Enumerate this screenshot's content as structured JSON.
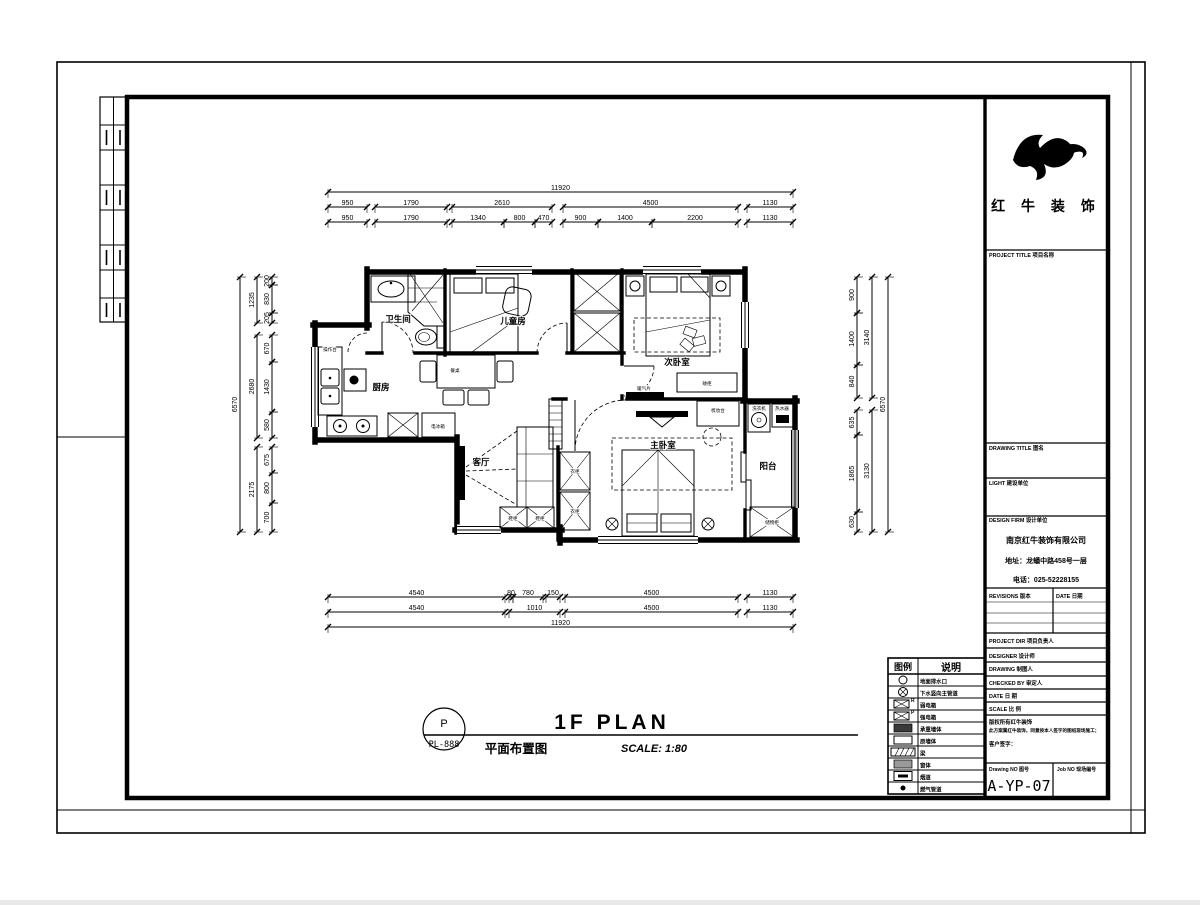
{
  "logo": {
    "company": "红 牛 装 饰"
  },
  "title_block": {
    "project_title": "PROJECT TITLE    项目名称",
    "drawing_title": "DRAWING TITLE    图名",
    "client": "LIGHT    建设单位",
    "design_firm": "DESIGN FIRM    设计单位",
    "firm_name": "南京红牛装饰有限公司",
    "firm_address": "地址：龙蟠中路458号一层",
    "firm_phone": "电话：025-52228155",
    "revisions_label": "REVISIONS  版本",
    "revisions_date_label": "DATE  日期",
    "project_dir": "PROJECT DIR    项目负责人",
    "designer": "DESIGNER    设计师",
    "drawing_by": "DRAWING    制图人",
    "checked_by": "CHECKED BY    审定人",
    "date_label": "DATE    日  期",
    "scale_label": "SCALE    比  例",
    "copyright_line1": "版权所有红牛装饰",
    "copyright_line2": "此方案属红牛装饰，同意按本人签字的图纸现场施工；",
    "copyright_line3": "客户签字：",
    "drawing_no_label": "Drawing NO  图号",
    "drawing_no": "A-YP-07",
    "job_no_label": "Job NO  现场编号"
  },
  "legend": {
    "headers": [
      "图例",
      "说明"
    ],
    "rows": [
      {
        "sym": "circle",
        "label": "地面排水口"
      },
      {
        "sym": "circle-cross",
        "label": "下水竖向主管道"
      },
      {
        "sym": "box-x",
        "mark": "R",
        "label": "弱电箱"
      },
      {
        "sym": "box-x",
        "mark": "P",
        "label": "强电箱"
      },
      {
        "sym": "solid",
        "label": "承重墙体"
      },
      {
        "sym": "hollow",
        "label": "原墙体"
      },
      {
        "sym": "beam",
        "label": "梁"
      },
      {
        "sym": "gray",
        "label": "窗体"
      },
      {
        "sym": "flue",
        "label": "烟道"
      },
      {
        "sym": "dot",
        "label": "燃气管道"
      }
    ]
  },
  "title_area": {
    "stamp_top": "P",
    "stamp_bottom": "PL-888",
    "title_en": "1F PLAN",
    "title_cn": "平面布置图",
    "scale": "SCALE: 1:80"
  },
  "plan": {
    "rooms": {
      "bathroom": "卫生间",
      "kids_room": "儿童房",
      "second_bedroom": "次卧室",
      "kitchen": "厨房",
      "living_room": "客厅",
      "master_bedroom": "主卧室",
      "balcony": "阳台"
    },
    "furniture": {
      "counter": "操作台",
      "fridge": "电冰箱",
      "dining_table": "餐桌",
      "shoe_cabinet": "鞋柜",
      "wardrobe": "衣柜",
      "radiator": "暖气片",
      "low_cabinet": "矮柜",
      "dresser": "梳妆台",
      "washer": "洗衣机",
      "water_heater": "热水器",
      "storage": "储物柜"
    },
    "dimensions": {
      "top_total": "11920",
      "top_row1": [
        "950",
        "1790",
        "2610",
        "4500",
        "1130"
      ],
      "top_row2": [
        "950",
        "1790",
        "1340",
        "800",
        "470",
        "900",
        "1400",
        "2200",
        "1130"
      ],
      "bottom_row1": [
        "4540",
        "80",
        "780",
        "150",
        "4500",
        "1130"
      ],
      "bottom_row2": [
        "4540",
        "1010",
        "4500",
        "1130"
      ],
      "bottom_total": "11920",
      "left_inner": [
        "200",
        "830",
        "205",
        "670",
        "1430",
        "580",
        "675",
        "800",
        "700"
      ],
      "left_mid": [
        "1235",
        "2680",
        "2175"
      ],
      "left_total": "6570",
      "right_inner": [
        "900",
        "1400",
        "840",
        "635",
        "1865",
        "630"
      ],
      "right_mid": [
        "3140",
        "3130"
      ],
      "right_total": "6570"
    }
  }
}
